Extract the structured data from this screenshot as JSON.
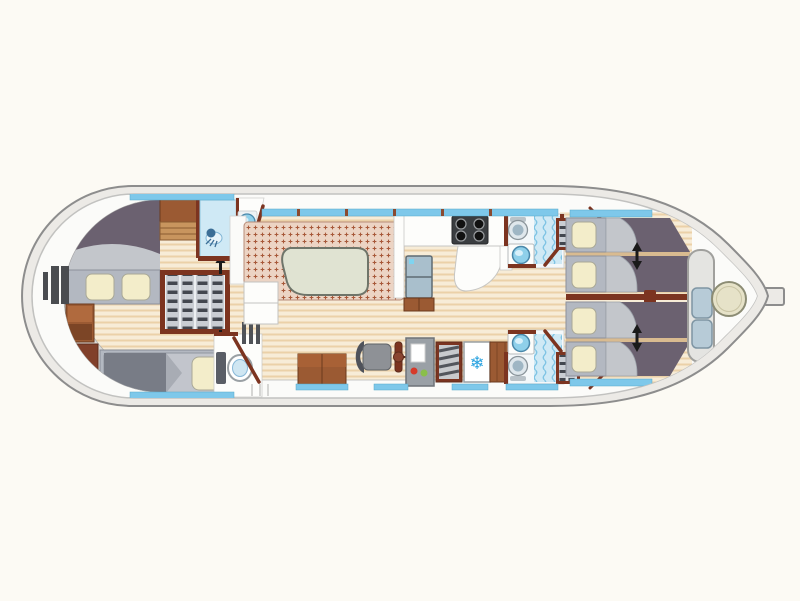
{
  "title": "Houseboat deck plan",
  "icons": {
    "snowflake": "❄"
  },
  "colors": {
    "background": "#fcfaf4",
    "hull_fill": "#eceae6",
    "hull_stroke": "#8d8d8d",
    "deck_fill": "#fbfbf9",
    "deck_stroke": "#c2c2c0",
    "stern_locker": "#dcdbd8",
    "wood_base": "#f7ecd7",
    "wood_stripe": "#ebd1a8",
    "wood_gap": "#d9bb90",
    "wall_maroon": "#7c3420",
    "wall_maroon_dark": "#5f2d1c",
    "cabinet_brown": "#9b5a33",
    "cabinet_brown_light": "#b06a3e",
    "cabinet_brown_dark": "#7c4526",
    "bed_mauve": "#6b6170",
    "blanket_gray": "#c3c6cb",
    "berth_gray": "#c2c5cc",
    "blanket_dark": "#787c86",
    "blanket_fold": "#a8acb4",
    "headboard_gray": "#b3b8c1",
    "headboard_stroke": "#8c919b",
    "pillow_cream": "#f3edca",
    "pillow_stroke": "#a9a896",
    "settee_base": "#ecd4c4",
    "settee_dot": "#a8593a",
    "table_sage": "#e0e3d2",
    "table_stroke": "#6f756a",
    "white_fixture": "#fdfdfb",
    "fixture_stroke": "#c6c6c4",
    "shower_blue": "#cfe9f5",
    "shower_wave": "#7fc4e4",
    "shower_head": "#3c6e96",
    "window_blue": "#7ec8ea",
    "window_stroke": "#55a8c8",
    "basin_blue": "#8fd0ea",
    "basin_stroke": "#4a88aa",
    "toilet_rim": "#8a949a",
    "toilet_inner": "#9fb6c4",
    "steel_gray": "#9aa0a6",
    "steel_dark": "#55585e",
    "stove_dark": "#3a3d40",
    "snowflake_blue": "#2ba3e0",
    "indicator_red": "#d63a2a",
    "indicator_green": "#8abf4a",
    "cushion_blue": "#b7cbd7",
    "cushion_stroke": "#7e95a3",
    "bow_bench": "#e4e4e1",
    "bow_table_fill": "#e6e2c8",
    "bow_table_stroke": "#8c8c74",
    "shelf_bg": "#c9cdd3",
    "shelf_gap": "#eceff2",
    "shelf_item": "#43474f",
    "fridge_blue": "#a9bfcc",
    "fridge_stroke": "#5f6b73",
    "arrow_black": "#1a1a1a",
    "ladder_gray": "#4a4c50"
  },
  "inventory": {
    "rooms": [
      "stern-deck",
      "aft-cabin",
      "aft-bathroom",
      "day-toilet",
      "salon",
      "galley",
      "helm-station",
      "bathroom-top",
      "bathroom-bottom",
      "bow-cabin-top",
      "bow-cabin-bottom",
      "bow-deck"
    ],
    "furniture": [
      "double-bed",
      "single-berth",
      "wardrobe",
      "aft-shower",
      "washbasin",
      "toilet",
      "settee",
      "salon-table",
      "sideboard",
      "nav-desk",
      "helm-seat",
      "steering-wheel",
      "instrument-panel",
      "companionway-steps",
      "freezer",
      "stove",
      "fridge",
      "berth-1",
      "berth-2",
      "berth-3",
      "berth-4",
      "bow-bench",
      "bow-table",
      "swim-ladder"
    ]
  }
}
